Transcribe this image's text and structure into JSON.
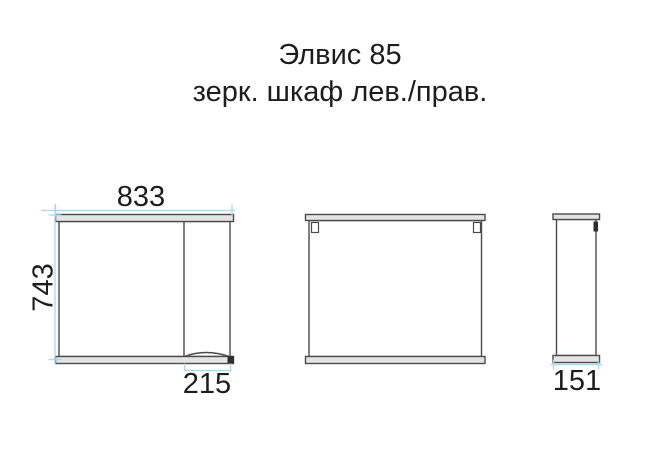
{
  "title": {
    "line1": "Элвис 85",
    "line2": "зерк. шкаф лев./прав."
  },
  "views": {
    "front": {
      "width": "833",
      "height": "743",
      "door_section_width": "215"
    },
    "side": {
      "depth": "151"
    }
  },
  "colors": {
    "background": "#ffffff",
    "outline": "#4b4b4b",
    "panel_fill": "#e4e4e4",
    "dimension_line": "#a7d8eb",
    "text": "#1d1d1d"
  }
}
